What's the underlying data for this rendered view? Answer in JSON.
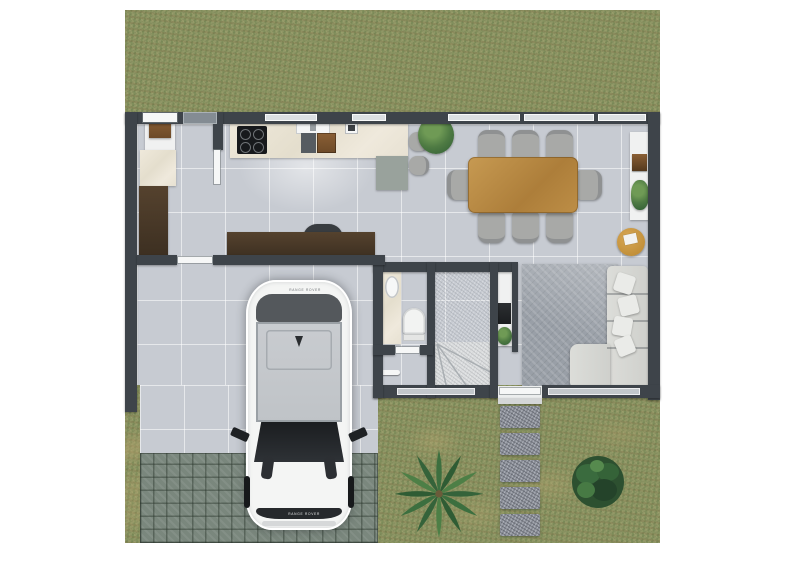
{
  "scene": {
    "description": "Top-down 3D architectural render of a ground floor plan with attached open garage, front garden, paver driveway and a parked white SUV",
    "car": {
      "kind": "white SUV seen from above, parked nose-out of the garage",
      "badge_rear": "RANGE ROVER",
      "badge_front": "RANGE ROVER",
      "body_color": "#f4f5f4"
    },
    "rooms": [
      {
        "name": "laundry-pantry"
      },
      {
        "name": "kitchen"
      },
      {
        "name": "study-nook"
      },
      {
        "name": "dining-area"
      },
      {
        "name": "living-room"
      },
      {
        "name": "powder-room"
      },
      {
        "name": "staircase"
      },
      {
        "name": "entry-hall"
      },
      {
        "name": "garage-carport"
      },
      {
        "name": "garden"
      },
      {
        "name": "driveway"
      }
    ],
    "furniture": [
      {
        "name": "kitchen-counter-with-cooktop-and-sink"
      },
      {
        "name": "kitchen-peninsula",
        "stools": 2
      },
      {
        "name": "tall-wood-cabinet"
      },
      {
        "name": "study-desk-with-chair"
      },
      {
        "name": "dining-table",
        "chairs": 8,
        "material": "wood"
      },
      {
        "name": "sideboard-shelf",
        "decor": [
          "wooden box",
          "trailing plant"
        ]
      },
      {
        "name": "round-side-table"
      },
      {
        "name": "sectional-sofa",
        "pillows": 4
      },
      {
        "name": "area-rug"
      },
      {
        "name": "coffee-console-with-espresso-machine"
      },
      {
        "name": "vanity-with-basin"
      },
      {
        "name": "toilet"
      },
      {
        "name": "towel-rail"
      }
    ],
    "garden": [
      {
        "name": "stepping-stones",
        "count": 5
      },
      {
        "name": "palm-tree"
      },
      {
        "name": "round-bush"
      },
      {
        "name": "potted-plant-dining"
      }
    ],
    "palette": {
      "page_bg": "#ffffff",
      "grass": "#8f9766",
      "wall": "#3e444a",
      "tile_floor": "#c7cbd2",
      "marble": "#eae4d6",
      "dark_wood": "#4a392b",
      "table_wood": "#b98a3f",
      "rug": "#999fa7",
      "sofa": "#d9dad7",
      "paver": "#7a877d",
      "stepping_stone": "#8b8f98",
      "plant_green": "#3c6f3f"
    }
  }
}
